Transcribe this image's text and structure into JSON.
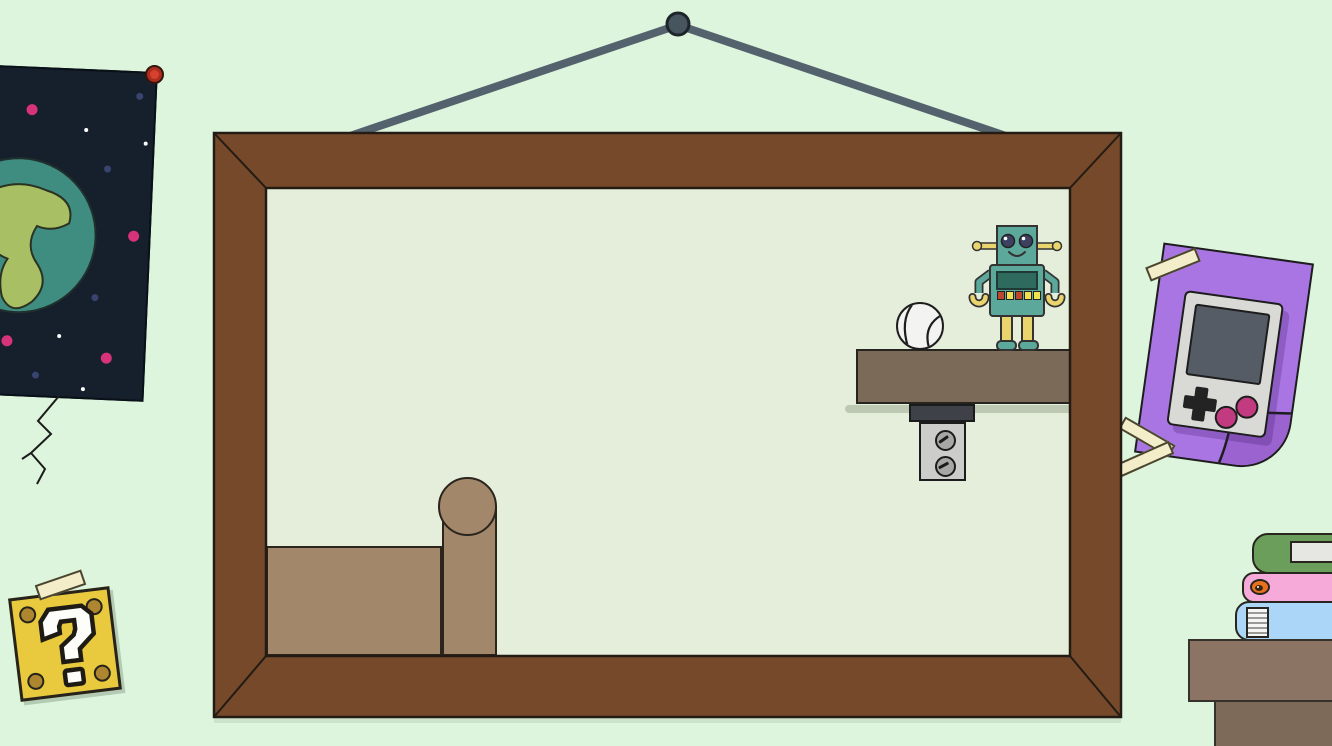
{
  "scene": {
    "background": "#dcf5dc",
    "description": "cartoon physics-game scene: wooden picture frame hanging on a nail; inside are a tan platform with post, a wall shelf holding a baseball and a smiling robot; around it a space poster, a cracked wall, a question block, a purple taped gameboy poster, stacked books on a desk corner"
  },
  "frame": {
    "wood_color": "#76492a",
    "outline_color": "#221c15",
    "inner_background": "#e4eeda",
    "wire_color": "#54626d",
    "nail_color": "#47555f"
  },
  "wall_crack": {
    "color": "#1c1c1c"
  },
  "space_poster": {
    "background": "#16202c",
    "pin_color": "#d8402f",
    "earth": {
      "ocean": "#3f8d81",
      "land": "#a9bf63"
    },
    "stars": {
      "white": [
        [
          115,
          59
        ],
        [
          175,
          70
        ],
        [
          97,
          266
        ],
        [
          123,
          318
        ]
      ],
      "blue": [
        [
          167,
          23
        ],
        [
          138,
          97
        ],
        [
          131,
          226
        ],
        [
          75,
          306
        ]
      ],
      "pink": [
        [
          60,
          41
        ],
        [
          167,
          163
        ],
        [
          45,
          273
        ],
        [
          145,
          286
        ]
      ]
    }
  },
  "question_block": {
    "fill": "#e9c93d",
    "rivet": "#ad862f",
    "mark_color": "#fdfdfa",
    "tape": "#f3edca"
  },
  "platform": {
    "fill": "#a2876b"
  },
  "shelf": {
    "fill": "#7b6a57",
    "bracket_cap": "#3f4148",
    "bracket_plate": "#cccccb",
    "screw": "#a7a7a5"
  },
  "baseball": {
    "fill": "#f3f3f1",
    "seam": "#1e1e1e"
  },
  "robot": {
    "body": "#5ca99b",
    "screen": "#2e6b5e",
    "accent": "#e9d46d",
    "eye": "#3d4060",
    "buttons": [
      "#c0452f",
      "#f2e14e",
      "#c0452f",
      "#f2e14e",
      "#f2e14e"
    ]
  },
  "gameboy_poster": {
    "paper": "#a975e3",
    "fold": "#9a63d0",
    "tape": "#f3edca",
    "device": {
      "body": "#d9d9d6",
      "screen": "#565c66",
      "dpad": "#232323",
      "button": "#c23b80"
    }
  },
  "books": [
    {
      "name": "green-book",
      "color": "#6b9e5a",
      "label_fill": "#e6e6e3"
    },
    {
      "name": "pink-book",
      "color": "#f5aada",
      "sticker": "#e8721c"
    },
    {
      "name": "blue-book",
      "color": "#abd6f7"
    }
  ],
  "desk": {
    "top": "#8b7464",
    "base": "#7d6a59"
  }
}
